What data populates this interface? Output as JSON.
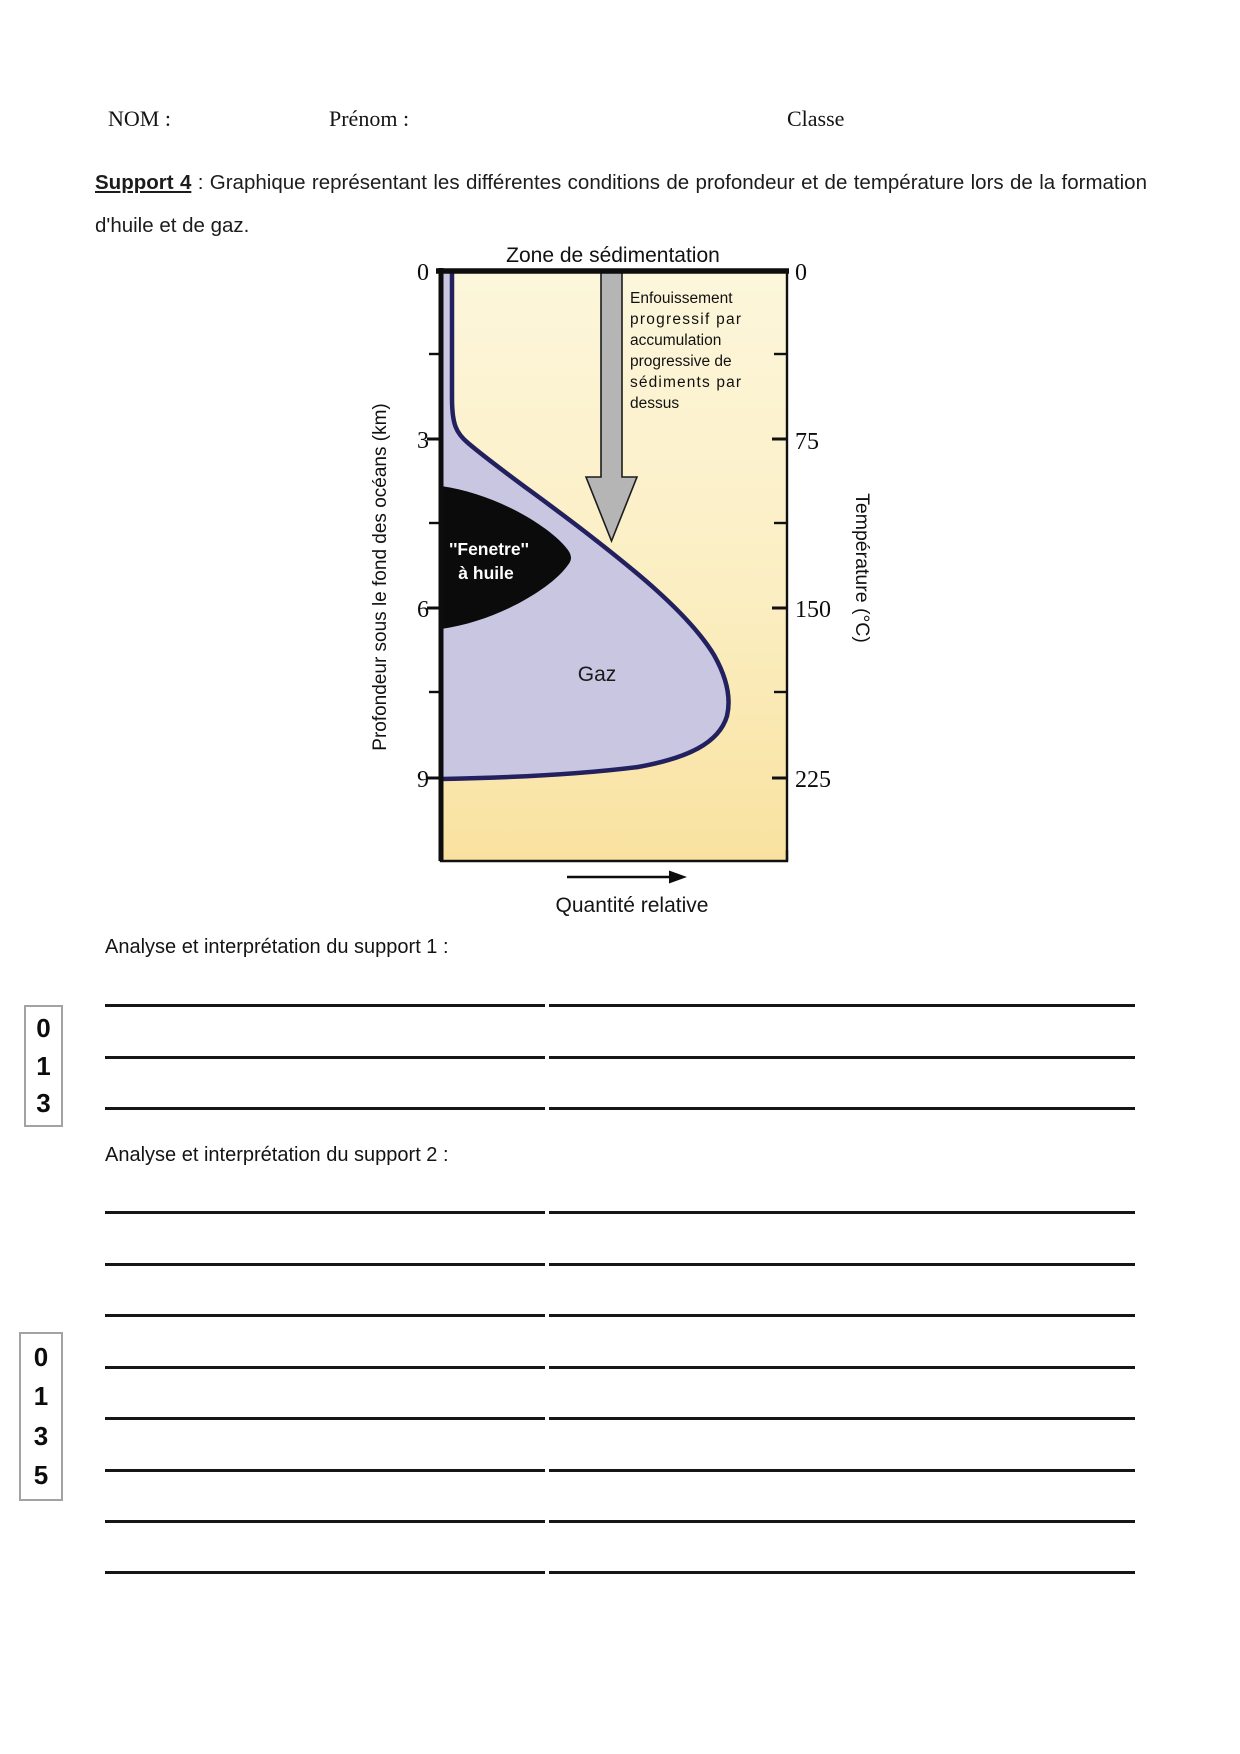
{
  "header": {
    "nom": "NOM :",
    "prenom": "Prénom :",
    "classe": "Classe"
  },
  "support": {
    "label": "Support 4",
    "text": " : Graphique représentant les différentes conditions de profondeur et de température lors de la formation d'huile et de gaz."
  },
  "figure": {
    "title": "Zone de sédimentation",
    "left_axis": {
      "label": "Profondeur sous le fond des océans (km)",
      "ticks": [
        "0",
        "3",
        "6",
        "9"
      ]
    },
    "right_axis": {
      "label": "Température (°C)",
      "ticks": [
        "0",
        "75",
        "150",
        "225"
      ]
    },
    "burial_note": [
      "Enfouissement",
      "progressif par",
      "accumulation",
      "progressive de",
      "sédiments par",
      "dessus"
    ],
    "oil_window": {
      "line1": "''Fenetre''",
      "line2": "à huile"
    },
    "gas_label": "Gaz",
    "x_axis_label": "Quantité relative",
    "colors": {
      "background_top": "#FCF6DB",
      "background_bottom": "#F9E2A0",
      "gas_area": "#C8C6E0",
      "curve": "#23205F",
      "oil_window": "#0B0B0B",
      "arrow": "#B5B5B5"
    }
  },
  "sections": [
    {
      "label": "Analyse et interprétation du support 1 :",
      "answer_line_count": 3,
      "grade_values": [
        "0",
        "1",
        "3"
      ]
    },
    {
      "label": "Analyse et interprétation du support 2 :",
      "answer_line_count": 8,
      "grade_values": [
        "0",
        "1",
        "3",
        "5"
      ]
    }
  ]
}
